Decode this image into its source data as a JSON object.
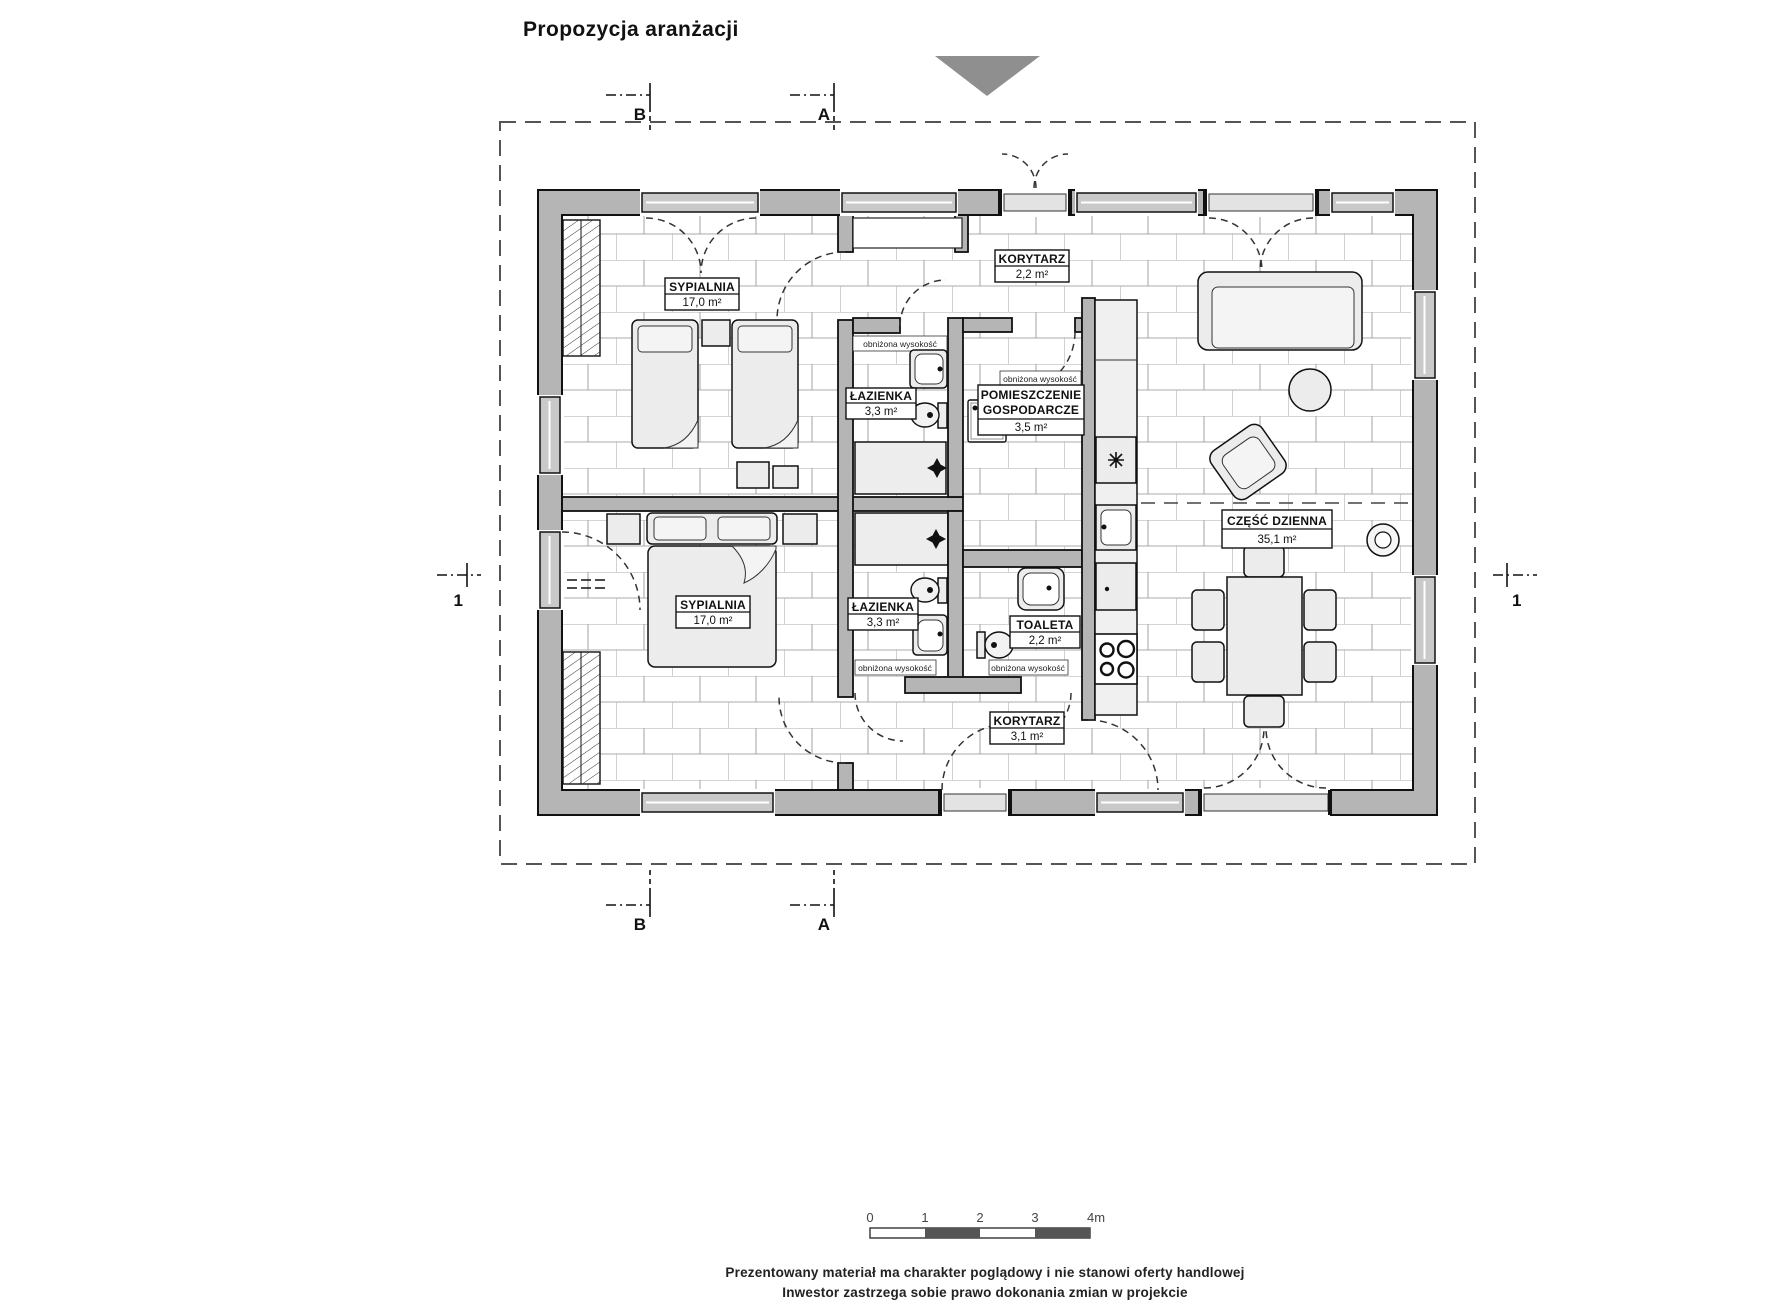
{
  "title": "Propozycja aranżacji",
  "plan": {
    "rooms": {
      "bedroom_top": {
        "name": "SYPIALNIA",
        "area": "17,0 m²"
      },
      "corridor_top": {
        "name": "KORYTARZ",
        "area": "2,2 m²"
      },
      "bathroom_top": {
        "name": "ŁAZIENKA",
        "area": "3,3 m²"
      },
      "utility": {
        "name_line1": "POMIESZCZENIE",
        "name_line2": "GOSPODARCZE",
        "area": "3,5 m²"
      },
      "living": {
        "name": "CZĘŚĆ DZIENNA",
        "area": "35,1 m²"
      },
      "bedroom_bottom": {
        "name": "SYPIALNIA",
        "area": "17,0 m²"
      },
      "bathroom_bottom": {
        "name": "ŁAZIENKA",
        "area": "3,3 m²"
      },
      "toilet": {
        "name": "TOALETA",
        "area": "2,2 m²"
      },
      "corridor_bottom": {
        "name": "KORYTARZ",
        "area": "3,1 m²"
      }
    },
    "annotations": {
      "lowered_height": "obniżona wysokość"
    },
    "section_markers": {
      "top_left": "B",
      "top_right": "A",
      "bottom_left": "B",
      "bottom_right": "A",
      "left": "1",
      "right": "1"
    }
  },
  "scale_bar": {
    "ticks": [
      "0",
      "1",
      "2",
      "3",
      "4m"
    ]
  },
  "footer": {
    "line1": "Prezentowany materiał ma charakter poglądowy i nie stanowi oferty handlowej",
    "line2": "Inwestor zastrzega sobie prawo dokonania zmian w projekcie"
  },
  "colors": {
    "wall": "#b5b5b5",
    "wall_outline": "#111111",
    "brick_line": "#ababab",
    "window": "#c9c9c9",
    "furniture": "#ececec",
    "marker_triangle": "#8f8f8f"
  }
}
